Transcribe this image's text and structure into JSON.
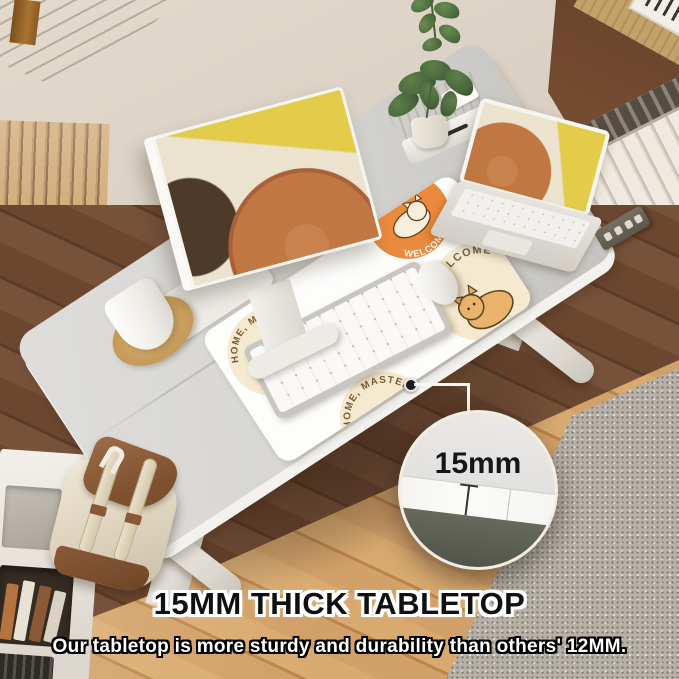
{
  "meta": {
    "type": "product-marketing-photo",
    "subject": "electric height-adjustable standing desk with 15mm thick tabletop in a home office"
  },
  "overlay": {
    "heading": "15MM THICK TABLETOP",
    "subheading": "Our tabletop is more sturdy and durability than others' 12MM.",
    "callout": {
      "label": "15mm"
    }
  },
  "desk_mat": {
    "badge_left_text": "HOME, MASTER",
    "badge_top_text": "WELCOME",
    "badge_right_text": "WELCOME",
    "badge_bottom_text": "HOME, MASTER"
  },
  "colors": {
    "wall_cream": "#d8cec1",
    "wall_brown": "#8a5d3d",
    "cork_tan": "#c3a16b",
    "shelf_wood": "#b07a3a",
    "slat_wood": "#c2975f",
    "radiator_white": "#e9e3d7",
    "desk_top": "#d7d6d3",
    "desk_edge_white": "#f4f2ee",
    "floor_dark": "#6b4730",
    "floor_light": "#d2a069",
    "rug_grey": "#b7b1a8",
    "mat_white": "#fdfdfc",
    "badge_cream": "#f5e9cf",
    "badge_orange": "#ea8a3d",
    "plant_green": "#4a663e",
    "art_orange": "#c07742",
    "art_yellow": "#e2cc4a",
    "art_brown": "#4e3a28",
    "art_cream": "#ece3cf",
    "callout_underside": "#67695d",
    "heading_black": "#101010",
    "text_white": "#ffffff"
  }
}
